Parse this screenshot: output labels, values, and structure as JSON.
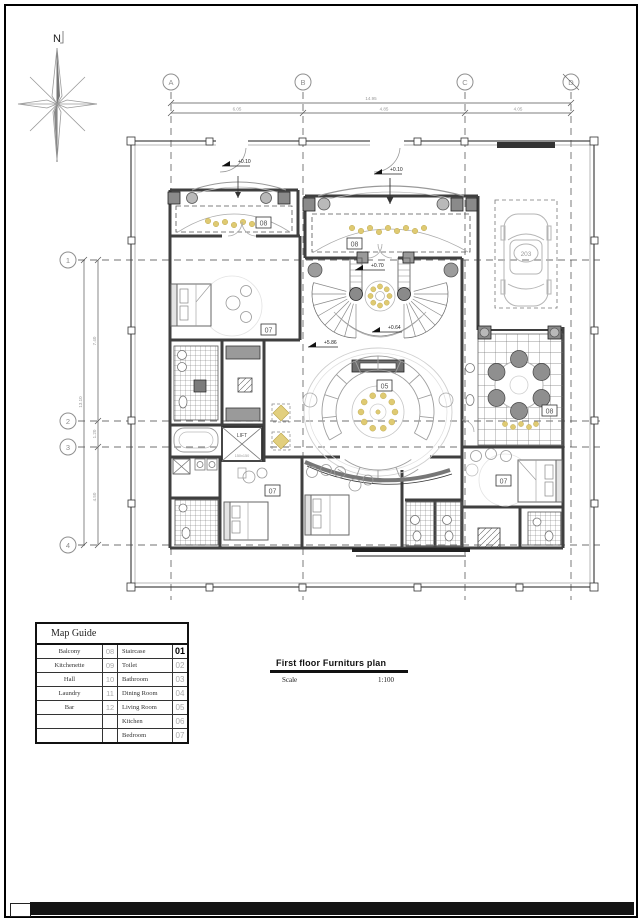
{
  "drawing": {
    "north_label": "N",
    "grid": {
      "columns": [
        "A",
        "B",
        "C",
        "D"
      ],
      "rows": [
        "1",
        "2",
        "3",
        "4"
      ]
    },
    "dimensions": {
      "top_total": "14.95",
      "top_segments": [
        "6.05",
        "4.85",
        "4.05"
      ],
      "left_total": "13.10",
      "left_segments": [
        "7.40",
        "1.20",
        "4.50"
      ]
    },
    "elevations": {
      "gate_left": "+0.10",
      "gate_mid": "+0.10",
      "stair": "+0.70",
      "hall": "+0.64",
      "living": "+5.86"
    },
    "rooms": {
      "balcony_top_left": "08",
      "balcony_top_mid": "08",
      "bedroom_left": "07",
      "living_room": "05",
      "balcony_patio": "08",
      "bedroom_bottom": "07",
      "bedroom_right": "07",
      "lift": "LIFT",
      "lift_size": "150x150",
      "car_plate": "203"
    }
  },
  "map_guide": {
    "title": "Map Guide",
    "left_rows": [
      {
        "label": "Balcony",
        "num": "08"
      },
      {
        "label": "Kitchenette",
        "num": "09"
      },
      {
        "label": "Hall",
        "num": "10"
      },
      {
        "label": "Laundry",
        "num": "11"
      },
      {
        "label": "Bar",
        "num": "12"
      },
      {
        "label": "",
        "num": ""
      },
      {
        "label": "",
        "num": ""
      }
    ],
    "right_rows": [
      {
        "label": "Staircase",
        "num": "01"
      },
      {
        "label": "Toilet",
        "num": "02"
      },
      {
        "label": "Bathroom",
        "num": "03"
      },
      {
        "label": "Dining Room",
        "num": "04"
      },
      {
        "label": "Living Room",
        "num": "05"
      },
      {
        "label": "Kitchen",
        "num": "06"
      },
      {
        "label": "Bedroom",
        "num": "07"
      }
    ]
  },
  "title_block": {
    "title": "First floor Furniturs plan",
    "scale_label": "Scale",
    "scale_value": "1:100"
  }
}
